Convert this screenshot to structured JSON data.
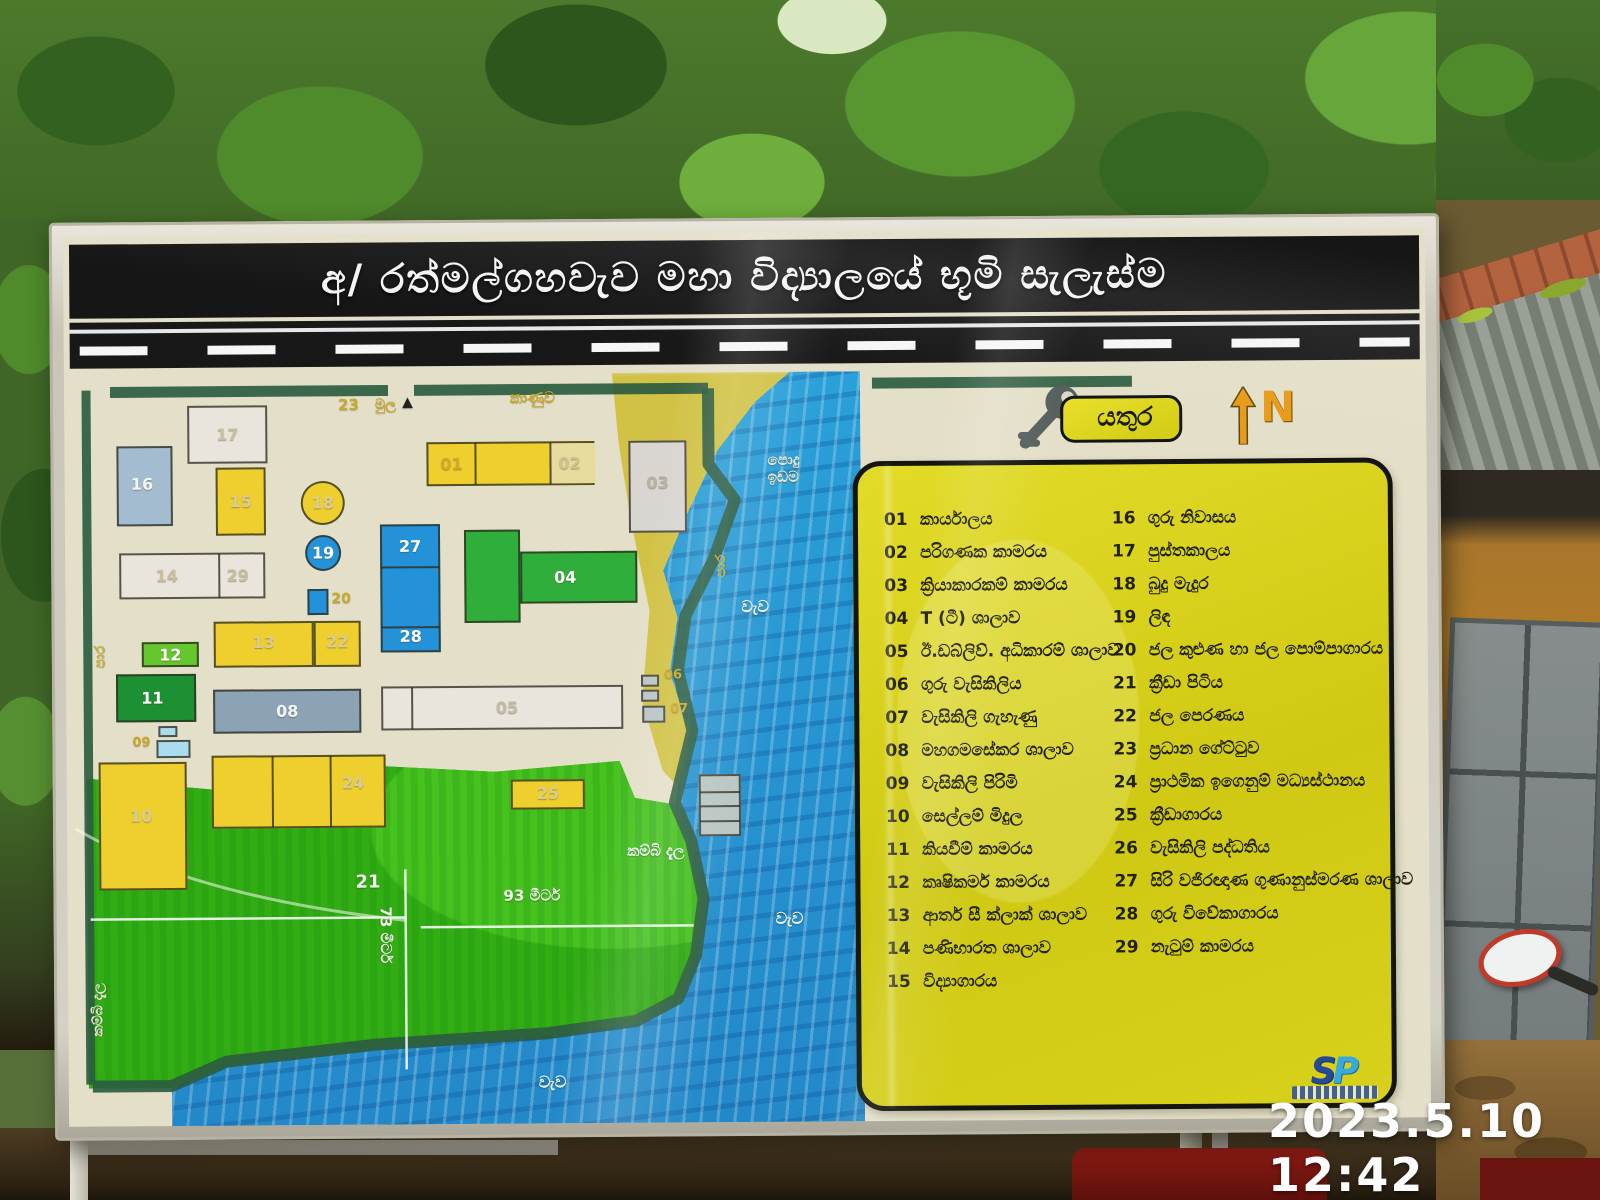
{
  "photo": {
    "timestamp": "2023.5.10 12:42"
  },
  "board": {
    "title": "අ/ රත්මල්ගහවැව මහා විද්‍යාලයේ භූමි සැලැස්ම",
    "key_label": "යතුර",
    "north_label": "N",
    "logo": {
      "s": "S",
      "p": "P"
    }
  },
  "legend": {
    "column1": [
      {
        "n": "01",
        "t": "කාර්යාලය"
      },
      {
        "n": "02",
        "t": "පරිගණක කාමරය"
      },
      {
        "n": "03",
        "t": "ක්‍රියාකාරකම් කාමරය"
      },
      {
        "n": "04",
        "t": "T (ටී) ශාලාව"
      },
      {
        "n": "05",
        "t": "ඊ.ඩබ්ලිව්. අධිකාරම් ශාලාව"
      },
      {
        "n": "06",
        "t": "ගුරු වැසිකිලිය"
      },
      {
        "n": "07",
        "t": "වැසිකිලි ගැහැණු"
      },
      {
        "n": "08",
        "t": "මහගමසේකර ශාලාව"
      },
      {
        "n": "09",
        "t": "වැසිකිලි පිරිමි"
      },
      {
        "n": "10",
        "t": "සෙල්ලම් මිදුල"
      },
      {
        "n": "11",
        "t": "කියවීම් කාමරය"
      },
      {
        "n": "12",
        "t": "කෘෂිකර්ම කාමරය"
      },
      {
        "n": "13",
        "t": "ආතර් සී ක්ලාක් ශාලාව"
      },
      {
        "n": "14",
        "t": "පණිභාරත ශාලාව"
      },
      {
        "n": "15",
        "t": "විද්‍යාගාරය"
      }
    ],
    "column2": [
      {
        "n": "16",
        "t": "ගුරු නිවාසය"
      },
      {
        "n": "17",
        "t": "පුස්තකාලය"
      },
      {
        "n": "18",
        "t": "බුදු මැදුර"
      },
      {
        "n": "19",
        "t": "ලිඳ"
      },
      {
        "n": "20",
        "t": "ජල කුළුණ හා ජල පොම්පාගාරය"
      },
      {
        "n": "21",
        "t": "ක්‍රීඩා පිටිය"
      },
      {
        "n": "22",
        "t": "ජල පෙරණය"
      },
      {
        "n": "23",
        "t": "ප්‍රධාන ගේට්ටුව"
      },
      {
        "n": "24",
        "t": "ප්‍රාථමික ඉගෙනුම් මධ්‍යස්ථානය"
      },
      {
        "n": "25",
        "t": "ක්‍රීඩාගාරය"
      },
      {
        "n": "26",
        "t": "වැසිකිලි පද්ධතිය"
      },
      {
        "n": "27",
        "t": "සිරි වජිරඥාණ ගුණානුස්මරණ ශාලාව"
      },
      {
        "n": "28",
        "t": "ගුරු විවේකාගාරය"
      },
      {
        "n": "29",
        "t": "නැටුම් කාමරය"
      }
    ]
  },
  "map": {
    "palette": {
      "yellow": "#eecf2e",
      "white": "#e9e5dd",
      "whitegray": "#d9d6d2",
      "blue": "#2492d8",
      "bluegray": "#a4bcd0",
      "green": "#2fae3c",
      "darkgreen": "#1d9033",
      "lightgreen": "#66c62e",
      "slate": "#8ca3b5",
      "lightblue": "#aadcee",
      "gray": "#b9c6c4"
    },
    "buildings": [
      {
        "id": "17",
        "c": "white",
        "x": 115,
        "y": 30,
        "w": 80,
        "h": 58,
        "labels": [
          {
            "t": "17",
            "lx": 50,
            "ly": 50,
            "col": "#c8bf9f"
          }
        ]
      },
      {
        "id": "16",
        "c": "bluegray",
        "x": 44,
        "y": 70,
        "w": 56,
        "h": 80,
        "labels": [
          {
            "t": "16",
            "lx": 45,
            "ly": 48,
            "col": "#f3f6f2"
          }
        ]
      },
      {
        "id": "15",
        "c": "yellow",
        "x": 143,
        "y": 92,
        "w": 50,
        "h": 68,
        "labels": [
          {
            "t": "15",
            "lx": 50,
            "ly": 50,
            "col": "#d9cc96"
          }
        ]
      },
      {
        "id": "18",
        "c": "yellow",
        "shape": "circle",
        "x": 228,
        "y": 106,
        "w": 44,
        "h": 44,
        "labels": [
          {
            "t": "18",
            "lx": 50,
            "ly": 50,
            "col": "#d9cc96"
          }
        ]
      },
      {
        "id": "19",
        "c": "blue",
        "shape": "circle",
        "x": 232,
        "y": 160,
        "w": 36,
        "h": 36,
        "labels": [
          {
            "t": "19",
            "lx": 50,
            "ly": 50,
            "col": "#ffffff"
          }
        ]
      },
      {
        "id": "14-29",
        "c": "white",
        "x": 46,
        "y": 177,
        "w": 146,
        "h": 46,
        "vlines": [
          97
        ],
        "labels": [
          {
            "t": "14",
            "lx": 32,
            "ly": 50,
            "col": "#c8bf9f"
          },
          {
            "t": "29",
            "lx": 82,
            "ly": 50,
            "col": "#c8bf9f"
          }
        ]
      },
      {
        "id": "20",
        "c": "blue",
        "x": 234,
        "y": 214,
        "w": 21,
        "h": 26,
        "labels": []
      },
      {
        "id": "27-28",
        "c": "blue",
        "x": 307,
        "y": 150,
        "w": 60,
        "h": 128,
        "hlines": [
          40,
          100
        ],
        "labels": [
          {
            "t": "27",
            "lx": 50,
            "ly": 16,
            "col": "#ffffff"
          },
          {
            "t": "28",
            "lx": 50,
            "ly": 89,
            "col": "#ffffff"
          }
        ]
      },
      {
        "id": "01-02",
        "c": "yellow",
        "x": 354,
        "y": 68,
        "w": 168,
        "h": 44,
        "vlines": [
          46,
          121
        ],
        "cells": [
          {
            "x": 121,
            "w": 46,
            "bg": "#e7dc9e"
          }
        ],
        "labels": [
          {
            "t": "01",
            "lx": 14,
            "ly": 50,
            "col": "#d3a92c"
          },
          {
            "t": "02",
            "lx": 86,
            "ly": 50,
            "col": "#cfc28a"
          }
        ]
      },
      {
        "id": "03",
        "c": "whitegray",
        "x": 556,
        "y": 68,
        "w": 58,
        "h": 92,
        "labels": [
          {
            "t": "03",
            "lx": 50,
            "ly": 45,
            "col": "#b9b2a2"
          }
        ]
      },
      {
        "id": "04a",
        "c": "green",
        "x": 391,
        "y": 156,
        "w": 56,
        "h": 93,
        "labels": []
      },
      {
        "id": "04b",
        "c": "green",
        "x": 447,
        "y": 178,
        "w": 117,
        "h": 52,
        "labels": [
          {
            "t": "04",
            "lx": 38,
            "ly": 50,
            "col": "#ffffff"
          }
        ]
      },
      {
        "id": "13",
        "c": "yellow",
        "x": 140,
        "y": 246,
        "w": 100,
        "h": 46,
        "labels": [
          {
            "t": "13",
            "lx": 50,
            "ly": 45,
            "col": "#d9cc96"
          }
        ]
      },
      {
        "id": "22",
        "c": "yellow",
        "x": 240,
        "y": 246,
        "w": 47,
        "h": 46,
        "labels": [
          {
            "t": "22",
            "lx": 50,
            "ly": 45,
            "col": "#d9cc96"
          }
        ]
      },
      {
        "id": "12",
        "c": "lightgreen",
        "x": 68,
        "y": 266,
        "w": 57,
        "h": 25,
        "labels": [
          {
            "t": "12",
            "lx": 50,
            "ly": 50,
            "col": "#ffffff"
          }
        ]
      },
      {
        "id": "11",
        "c": "darkgreen",
        "x": 42,
        "y": 298,
        "w": 80,
        "h": 48,
        "labels": [
          {
            "t": "11",
            "lx": 45,
            "ly": 50,
            "col": "#ffffff"
          }
        ]
      },
      {
        "id": "09a",
        "c": "lightblue",
        "x": 84,
        "y": 350,
        "w": 19,
        "h": 11,
        "labels": []
      },
      {
        "id": "09b",
        "c": "lightblue",
        "x": 82,
        "y": 364,
        "w": 34,
        "h": 18,
        "labels": []
      },
      {
        "id": "10",
        "c": "yellow",
        "x": 24,
        "y": 386,
        "w": 88,
        "h": 128,
        "labels": [
          {
            "t": "10",
            "lx": 48,
            "ly": 42,
            "col": "#d9cc96"
          }
        ]
      },
      {
        "id": "08",
        "c": "slate",
        "x": 139,
        "y": 314,
        "w": 148,
        "h": 44,
        "labels": [
          {
            "t": "08",
            "lx": 50,
            "ly": 50,
            "col": "#f2f5f8"
          }
        ]
      },
      {
        "id": "05",
        "c": "white",
        "x": 307,
        "y": 312,
        "w": 242,
        "h": 44,
        "vlines": [
          28
        ],
        "labels": [
          {
            "t": "05",
            "lx": 52,
            "ly": 50,
            "col": "#c4bba6"
          }
        ]
      },
      {
        "id": "06a",
        "c": "gray",
        "x": 567,
        "y": 302,
        "w": 18,
        "h": 12,
        "labels": []
      },
      {
        "id": "06b",
        "c": "gray",
        "x": 567,
        "y": 317,
        "w": 18,
        "h": 12,
        "labels": []
      },
      {
        "id": "07",
        "c": "gray",
        "x": 568,
        "y": 333,
        "w": 23,
        "h": 17,
        "labels": []
      },
      {
        "id": "24",
        "c": "yellow",
        "x": 137,
        "y": 380,
        "w": 174,
        "h": 73,
        "vlines": [
          58,
          116
        ],
        "labels": [
          {
            "t": "24",
            "lx": 82,
            "ly": 38,
            "col": "#d9cc96"
          }
        ]
      },
      {
        "id": "25",
        "c": "yellow",
        "x": 436,
        "y": 406,
        "w": 74,
        "h": 30,
        "labels": [
          {
            "t": "25",
            "lx": 50,
            "ly": 48,
            "col": "#d9cc96"
          }
        ]
      },
      {
        "id": "26",
        "c": "gray",
        "x": 624,
        "y": 402,
        "w": 42,
        "h": 62,
        "rows": 4,
        "labels": []
      }
    ],
    "labels": [
      {
        "t": "23",
        "x": 266,
        "y": 22,
        "c": "#c9a82a",
        "fs": 15
      },
      {
        "t": "මුල",
        "x": 303,
        "y": 22,
        "c": "#c9a82a",
        "fs": 14
      },
      {
        "t": "▲",
        "x": 330,
        "y": 20,
        "c": "#222222",
        "fs": 14
      },
      {
        "t": "කාණුව",
        "x": 438,
        "y": 16,
        "c": "#c9a82a",
        "fs": 15
      },
      {
        "t": "පොදු\nඉඩම",
        "x": 695,
        "y": 80,
        "c": "#e9e4cf",
        "fs": 15
      },
      {
        "t": "වැව",
        "x": 668,
        "y": 226,
        "c": "#eef4f6",
        "fs": 16
      },
      {
        "t": "වැව",
        "x": 700,
        "y": 538,
        "c": "#eef4f6",
        "fs": 16
      },
      {
        "t": "වැව",
        "x": 462,
        "y": 700,
        "c": "#eef4f6",
        "fs": 16
      },
      {
        "t": "කම්බි දැල",
        "x": 552,
        "y": 470,
        "c": "#eef4f6",
        "fs": 15
      },
      {
        "t": "කම්බි දැල",
        "x": 14,
        "y": 660,
        "c": "#e8e4d4",
        "fs": 14,
        "rot": -90
      },
      {
        "t": "93 මීටර්",
        "x": 428,
        "y": 514,
        "c": "#f2f2ea",
        "fs": 15
      },
      {
        "t": "73 මීටර්",
        "x": 318,
        "y": 532,
        "c": "#f2f2ea",
        "fs": 15,
        "rot": 90
      },
      {
        "t": "පාර",
        "x": 18,
        "y": 292,
        "c": "#c9b23a",
        "fs": 14,
        "rot": -90
      },
      {
        "t": "පාර",
        "x": 640,
        "y": 205,
        "c": "#c9b23a",
        "fs": 14,
        "rot": -90
      },
      {
        "t": "21",
        "x": 280,
        "y": 498,
        "c": "#f2f6ee",
        "fs": 18
      },
      {
        "t": "06",
        "x": 590,
        "y": 296,
        "c": "#c9a82a",
        "fs": 13
      },
      {
        "t": "07",
        "x": 596,
        "y": 330,
        "c": "#c9a82a",
        "fs": 13
      },
      {
        "t": "09",
        "x": 58,
        "y": 360,
        "c": "#c9a82a",
        "fs": 13
      },
      {
        "t": "20",
        "x": 258,
        "y": 216,
        "c": "#c9a82a",
        "fs": 14
      }
    ]
  }
}
